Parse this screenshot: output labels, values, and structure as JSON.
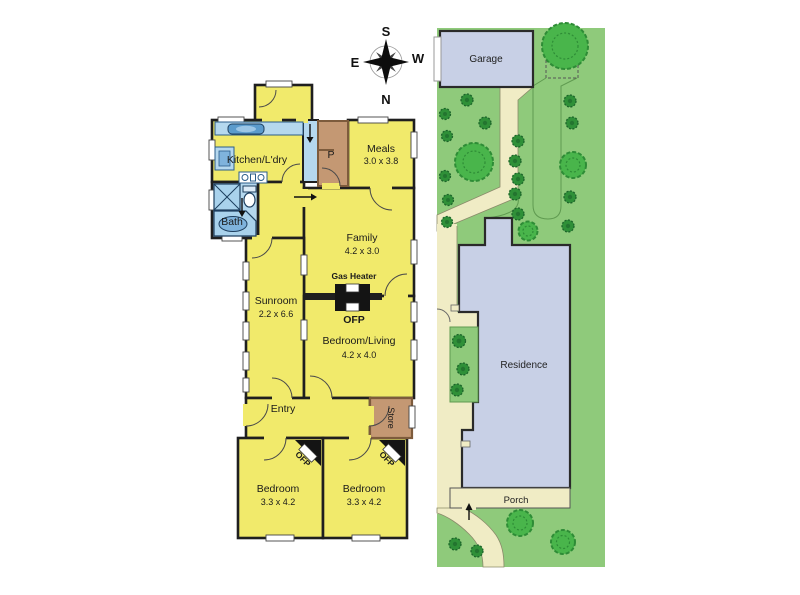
{
  "compass": {
    "s": "S",
    "w": "W",
    "e": "E",
    "n": "N"
  },
  "floorplan": {
    "kitchen": {
      "name": "Kitchen/L'dry"
    },
    "pantry": {
      "abbr": "P"
    },
    "meals": {
      "name": "Meals",
      "dims": "3.0 x 3.8"
    },
    "bath": {
      "name": "Bath"
    },
    "family": {
      "name": "Family",
      "dims": "4.2 x 3.0"
    },
    "gas_heater": {
      "label": "Gas Heater",
      "ofp": "OFP"
    },
    "sunroom": {
      "name": "Sunroom",
      "dims": "2.2 x 6.6"
    },
    "bedroom_living": {
      "name": "Bedroom/Living",
      "dims": "4.2 x 4.0"
    },
    "entry": {
      "name": "Entry"
    },
    "store": {
      "name": "Store"
    },
    "bedroom_left": {
      "name": "Bedroom",
      "dims": "3.3 x 4.2",
      "ofp": "OFP"
    },
    "bedroom_right": {
      "name": "Bedroom",
      "dims": "3.3 x 4.2",
      "ofp": "OFP"
    }
  },
  "siteplan": {
    "garage": "Garage",
    "residence": "Residence",
    "porch": "Porch"
  },
  "colors": {
    "room_fill": "#f1ea6b",
    "wet_area": "#b5d8ee",
    "fixture_blue": "#5b9bcc",
    "timber": "#c49873",
    "wall": "#1f1f1f",
    "lawn": "#8fca7b",
    "shrub": "#2f9038",
    "tree": "#49b54b",
    "path": "#f0ecc5",
    "building": "#c8d0e6"
  }
}
